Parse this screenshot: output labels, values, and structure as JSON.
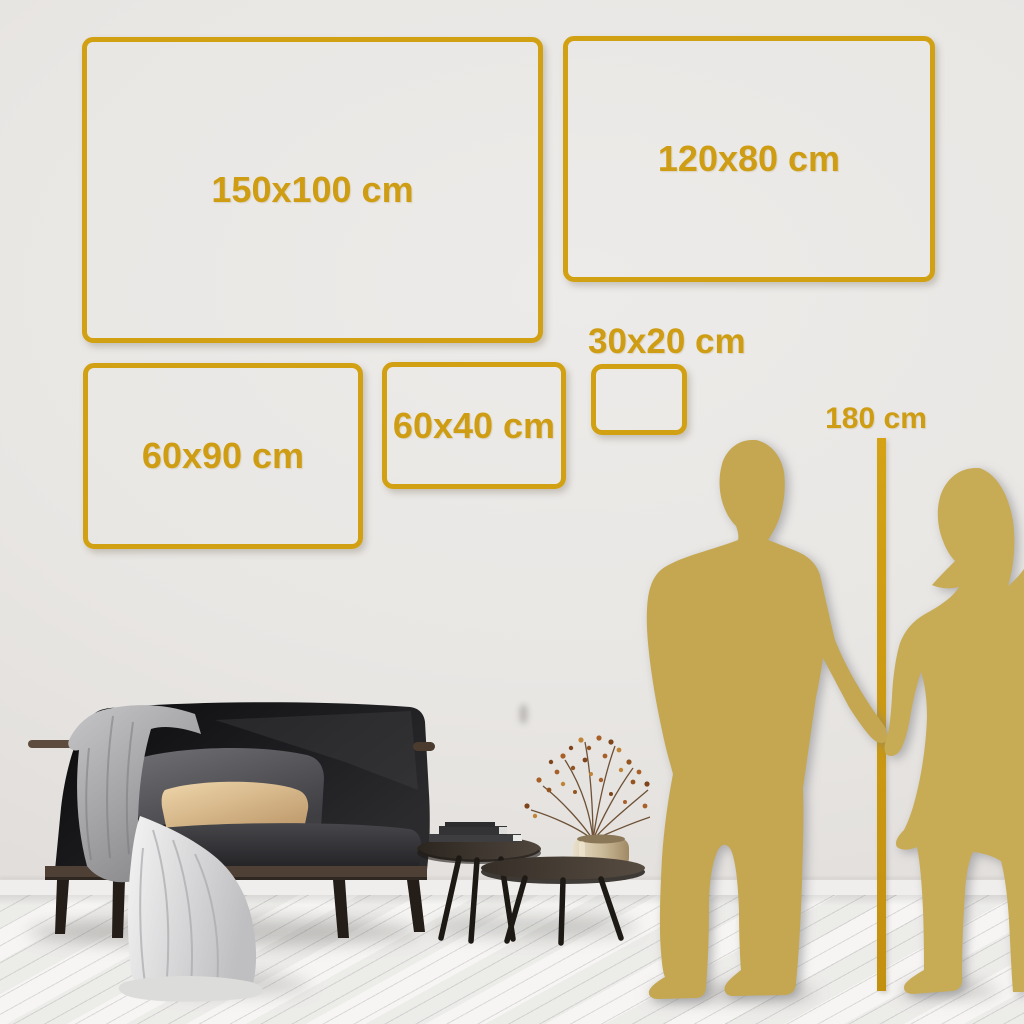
{
  "scene": {
    "type": "wall-art-size-guide",
    "colors": {
      "accent_gold": "#d2a013",
      "label_gold": "#cf9d13",
      "silhouette_gold": "#c6a953",
      "wall": "#e9e7e4",
      "floor": "#f3f2ef",
      "sofa_dark": "#1a1a1d",
      "pillow_beige": "#d9b98a",
      "blanket_gray": "#bdbdbf",
      "vase_brass": "#c3ab84"
    }
  },
  "size_frames": [
    {
      "label": "150x100 cm",
      "width_cm": 150,
      "height_cm": 100
    },
    {
      "label": "120x80 cm",
      "width_cm": 120,
      "height_cm": 80
    },
    {
      "label": "60x90 cm",
      "width_cm": 60,
      "height_cm": 90
    },
    {
      "label": "60x40 cm",
      "width_cm": 60,
      "height_cm": 40
    },
    {
      "label": "30x20 cm",
      "width_cm": 30,
      "height_cm": 20
    }
  ],
  "height_ruler": {
    "label": "180 cm",
    "height_cm": 180
  }
}
